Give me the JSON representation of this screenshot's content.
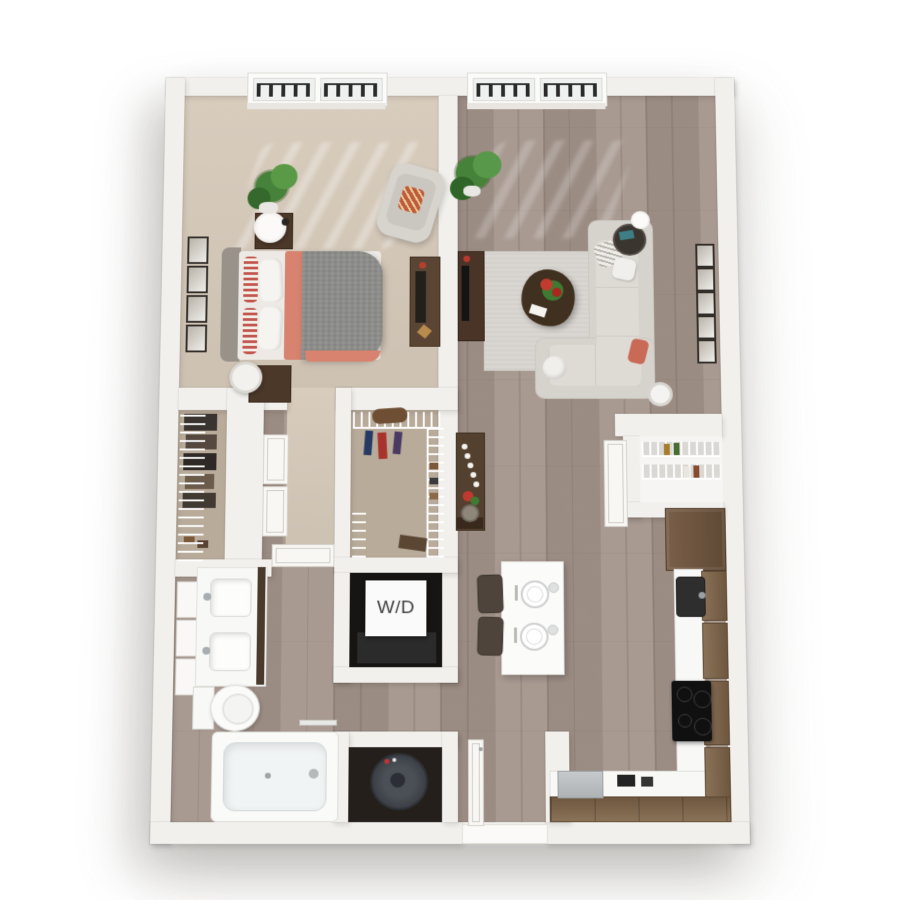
{
  "floorplan": {
    "type": "3d-rendered-apartment-floor-plan",
    "laundry_label": "W/D",
    "palette": {
      "canvas": "#ffffff",
      "wall": "#f2f0ec",
      "wall_edge": "#d9d5cf",
      "wood_floor": "#a3948a",
      "carpet": "#cdc1b2",
      "closet_carpet": "#b9ab9a",
      "accent_coral": "#d8836f",
      "sofa_gray": "#d6d3cd",
      "cabinet_wood": "#7a6450",
      "counter_white": "#f8f8f7",
      "appliance_dark": "#161616",
      "rug_gray": "#d9d6d1",
      "plant_green": "#47823a",
      "railing_dark": "#2a2a2a"
    },
    "rooms": [
      {
        "name": "bedroom",
        "floor": "carpet",
        "furniture": [
          "french-window-with-railing",
          "bed",
          "headboard",
          "striped-pillows",
          "white-pillows",
          "gray-duvet",
          "coral-throw",
          "nightstand",
          "table-lamp",
          "nightstand",
          "laundry-basket",
          "accent-chair",
          "accent-pillow",
          "potted-plant",
          "wall-art-frames",
          "desk"
        ]
      },
      {
        "name": "living-room",
        "floor": "wood",
        "furniture": [
          "french-window-with-railing",
          "sectional-sofa",
          "throw-pillows",
          "decor-vase",
          "area-rug",
          "coffee-table",
          "flower-centerpiece",
          "books",
          "tv-console",
          "tv",
          "side-table",
          "table-lamp",
          "potted-plant",
          "wall-art-frames"
        ]
      },
      {
        "name": "reach-in-closet",
        "floor": "carpet",
        "furniture": [
          "wire-shelving",
          "hanging-clothes",
          "shoes",
          "double-doors"
        ]
      },
      {
        "name": "walk-in-closet",
        "floor": "carpet",
        "furniture": [
          "wire-shelving",
          "hanging-ties",
          "duffel-bag",
          "shoes"
        ]
      },
      {
        "name": "bathroom",
        "floor": "wood",
        "furniture": [
          "double-vanity",
          "sink",
          "sink",
          "faucets",
          "mirror-panels",
          "toilet",
          "towel-bar",
          "bathtub",
          "tub-faucet",
          "door"
        ]
      },
      {
        "name": "laundry-closet",
        "label": "W/D",
        "furniture": [
          "stacked-washer-dryer"
        ]
      },
      {
        "name": "utility-closet",
        "furniture": [
          "water-heater"
        ]
      },
      {
        "name": "hallway",
        "furniture": [
          "console-table",
          "candles",
          "flowers",
          "decor-tray"
        ]
      },
      {
        "name": "kitchen",
        "floor": "wood",
        "furniture": [
          "island",
          "place-setting",
          "place-setting",
          "glassware",
          "bar-stool",
          "bar-stool",
          "refrigerator",
          "kitchen-sink",
          "faucet",
          "cooktop",
          "dishwasher",
          "upper-cabinets",
          "counter",
          "pantry-wire-shelving",
          "pantry-door"
        ]
      },
      {
        "name": "entry",
        "furniture": [
          "entry-door",
          "threshold"
        ]
      }
    ]
  }
}
